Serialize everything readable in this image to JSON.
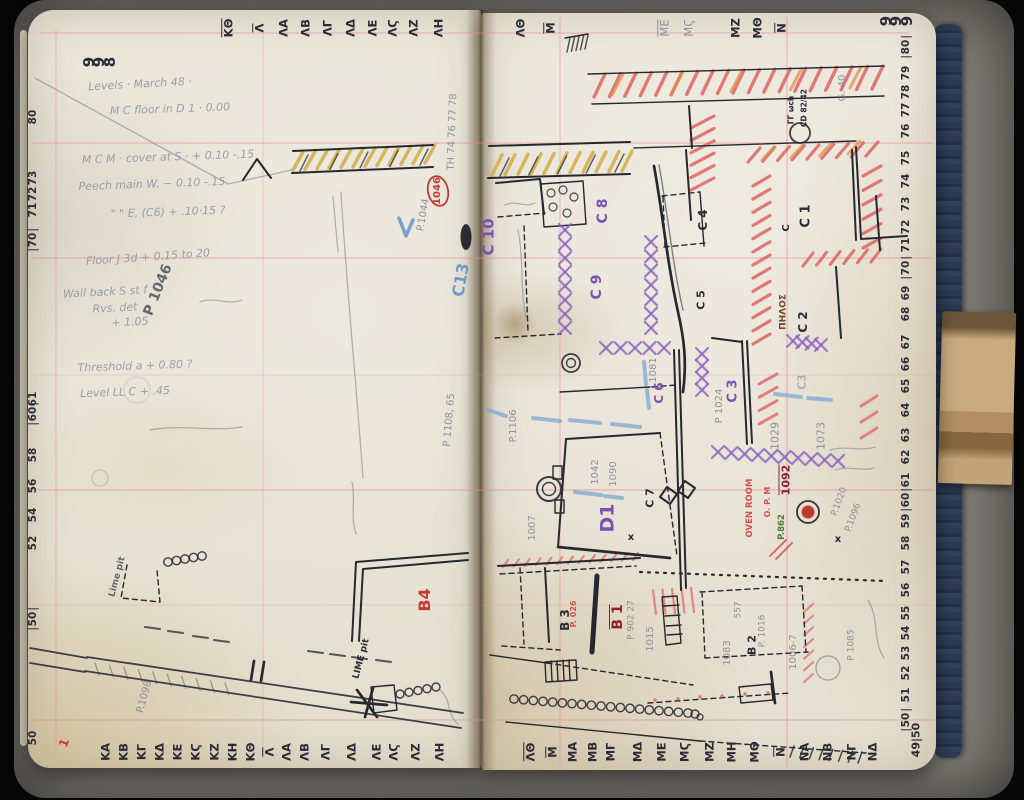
{
  "pages": {
    "left_page_number": "998",
    "right_page_number": "999",
    "corner_grid_ref": "49|50"
  },
  "scales": {
    "top": {
      "y": 28,
      "items": [
        {
          "t": "ΚΘ",
          "x": 228,
          "u": 1
        },
        {
          "t": "Λ",
          "x": 259,
          "u": 1
        },
        {
          "t": "ΛΑ",
          "x": 284
        },
        {
          "t": "ΛΒ",
          "x": 306
        },
        {
          "t": "ΛΓ",
          "x": 328
        },
        {
          "t": "ΛΔ",
          "x": 351
        },
        {
          "t": "ΛΕ",
          "x": 373
        },
        {
          "t": "ΛϚ",
          "x": 393
        },
        {
          "t": "ΛΖ",
          "x": 414
        },
        {
          "t": "ΛΗ",
          "x": 439
        },
        {
          "t": "ΛΘ",
          "x": 521
        },
        {
          "t": "Μ",
          "x": 550,
          "u": 1
        },
        {
          "t": "ΜΕ",
          "x": 664,
          "c": "pencil",
          "u": 1
        },
        {
          "t": "ΜϚ",
          "x": 689,
          "c": "pencil"
        },
        {
          "t": "ΜΖ",
          "x": 736
        },
        {
          "t": "ΜΘ",
          "x": 758
        },
        {
          "t": "Ν",
          "x": 781,
          "u": 1
        }
      ]
    },
    "bottom": {
      "y": 752,
      "items": [
        {
          "t": "ΚΑ",
          "x": 106
        },
        {
          "t": "ΚΒ",
          "x": 124
        },
        {
          "t": "ΚΓ",
          "x": 142
        },
        {
          "t": "ΚΔ",
          "x": 160
        },
        {
          "t": "ΚΕ",
          "x": 178
        },
        {
          "t": "ΚϚ",
          "x": 196
        },
        {
          "t": "ΚΖ",
          "x": 215
        },
        {
          "t": "ΚΗ",
          "x": 233
        },
        {
          "t": "ΚΘ",
          "x": 251
        },
        {
          "t": "Λ",
          "x": 269,
          "u": 1
        },
        {
          "t": "ΛΑ",
          "x": 287
        },
        {
          "t": "ΛΒ",
          "x": 305
        },
        {
          "t": "ΛΓ",
          "x": 326
        },
        {
          "t": "ΛΔ",
          "x": 352
        },
        {
          "t": "ΛΕ",
          "x": 377
        },
        {
          "t": "ΛϚ",
          "x": 394
        },
        {
          "t": "ΛΖ",
          "x": 416
        },
        {
          "t": "ΛΗ",
          "x": 440
        },
        {
          "t": "ΛΘ",
          "x": 530,
          "u": 1
        },
        {
          "t": "Μ",
          "x": 552,
          "u": 1
        },
        {
          "t": "ΜΑ",
          "x": 573
        },
        {
          "t": "ΜΒ",
          "x": 593
        },
        {
          "t": "ΜΓ",
          "x": 611
        },
        {
          "t": "ΜΔ",
          "x": 638
        },
        {
          "t": "ΜΕ",
          "x": 662
        },
        {
          "t": "ΜϚ",
          "x": 685
        },
        {
          "t": "ΜΖ",
          "x": 710
        },
        {
          "t": "ΜΗ",
          "x": 732
        },
        {
          "t": "ΜΘ",
          "x": 755
        },
        {
          "t": "Ν",
          "x": 780,
          "u": 1
        },
        {
          "t": "ΝΑ",
          "x": 805
        },
        {
          "t": "ΝΒ",
          "x": 828
        },
        {
          "t": "ΝΓ",
          "x": 852
        },
        {
          "t": "ΝΔ",
          "x": 873
        }
      ]
    },
    "left": {
      "x": 33,
      "items": [
        {
          "t": "80",
          "y": 117
        },
        {
          "t": "73",
          "y": 178
        },
        {
          "t": "72",
          "y": 194
        },
        {
          "t": "71",
          "y": 210
        },
        {
          "t": "70",
          "y": 240,
          "bx": 1
        },
        {
          "t": "61",
          "y": 399
        },
        {
          "t": "60",
          "y": 414,
          "bx": 1
        },
        {
          "t": "58",
          "y": 455
        },
        {
          "t": "56",
          "y": 486
        },
        {
          "t": "54",
          "y": 515
        },
        {
          "t": "52",
          "y": 543
        },
        {
          "t": "50",
          "y": 619,
          "bx": 1
        },
        {
          "t": "50",
          "y": 738
        }
      ]
    },
    "right": {
      "x": 906,
      "items": [
        {
          "t": "80",
          "y": 47,
          "bx": 1
        },
        {
          "t": "79",
          "y": 73
        },
        {
          "t": "78",
          "y": 92
        },
        {
          "t": "77",
          "y": 110
        },
        {
          "t": "76",
          "y": 131
        },
        {
          "t": "75",
          "y": 158
        },
        {
          "t": "74",
          "y": 181
        },
        {
          "t": "73",
          "y": 204
        },
        {
          "t": "72",
          "y": 227
        },
        {
          "t": "71",
          "y": 245
        },
        {
          "t": "70",
          "y": 268,
          "bx": 1
        },
        {
          "t": "69",
          "y": 293
        },
        {
          "t": "68",
          "y": 314
        },
        {
          "t": "67",
          "y": 342
        },
        {
          "t": "66",
          "y": 364
        },
        {
          "t": "65",
          "y": 386
        },
        {
          "t": "64",
          "y": 410
        },
        {
          "t": "63",
          "y": 435
        },
        {
          "t": "62",
          "y": 457
        },
        {
          "t": "61",
          "y": 480
        },
        {
          "t": "60",
          "y": 500,
          "bx": 1
        },
        {
          "t": "59",
          "y": 521
        },
        {
          "t": "58",
          "y": 543
        },
        {
          "t": "57",
          "y": 567
        },
        {
          "t": "56",
          "y": 590
        },
        {
          "t": "55",
          "y": 613
        },
        {
          "t": "54",
          "y": 633
        },
        {
          "t": "53",
          "y": 653
        },
        {
          "t": "52",
          "y": 673
        },
        {
          "t": "51",
          "y": 695
        },
        {
          "t": "50",
          "y": 720,
          "bx": 1
        }
      ]
    }
  },
  "notes": {
    "lines": [
      {
        "t": "Levels · March 48 ·",
        "x": 140,
        "y": 84,
        "r": -3
      },
      {
        "t": "M C floor in D 1 · 0.00",
        "x": 170,
        "y": 109,
        "r": -2
      },
      {
        "t": "M C M · cover at S · + 0.10 -.15",
        "x": 168,
        "y": 157,
        "r": -2
      },
      {
        "t": "Peech main W.  − 0.10 -.15",
        "x": 152,
        "y": 184,
        "r": -2
      },
      {
        "t": "\"  \"  E, (C6) + .10·15  ?",
        "x": 168,
        "y": 212,
        "r": -2
      },
      {
        "t": "Floor J 3d  + 0.15 to 20",
        "x": 148,
        "y": 257,
        "r": -4
      },
      {
        "t": "Wall back S st f",
        "x": 105,
        "y": 292,
        "r": -3
      },
      {
        "t": "Rvs. det",
        "x": 115,
        "y": 308,
        "r": -3
      },
      {
        "t": "+ 1.05",
        "x": 130,
        "y": 322,
        "r": -3
      },
      {
        "t": "Threshold a  + 0.80 ?",
        "x": 135,
        "y": 366,
        "r": -2
      },
      {
        "t": "Level LL C  + .45",
        "x": 125,
        "y": 392,
        "r": -2
      }
    ]
  },
  "labels": [
    {
      "t": "998",
      "x": 100,
      "y": 62,
      "cr": 1,
      "c": "ink",
      "s": 15,
      "n": "page-number-left"
    },
    {
      "t": "999",
      "x": 897,
      "y": 21,
      "cr": 1,
      "c": "ink",
      "s": 15,
      "n": "page-number-right"
    },
    {
      "t": "49|50",
      "x": 916,
      "y": 740,
      "c": "ink",
      "s": 11,
      "n": "corner-grid-ref"
    },
    {
      "t": "P 1046",
      "x": 158,
      "y": 290,
      "r": -68,
      "c": "pencil-dk",
      "s": 14
    },
    {
      "t": "1046",
      "x": 438,
      "y": 191,
      "c": "red",
      "s": 10
    },
    {
      "t": "P.1044",
      "x": 424,
      "y": 215,
      "r": -80,
      "c": "pencil",
      "s": 10
    },
    {
      "t": "TH 74 76 77 78",
      "x": 453,
      "y": 132,
      "r": -88,
      "c": "pencil",
      "s": 10
    },
    {
      "t": "C13",
      "x": 461,
      "y": 280,
      "r": -80,
      "c": "blue",
      "s": 16
    },
    {
      "t": "P 1108, 65",
      "x": 450,
      "y": 420,
      "r": -85,
      "c": "pencil",
      "s": 10
    },
    {
      "t": "Lime pit",
      "x": 118,
      "y": 577,
      "r": -75,
      "c": "pencil-dk",
      "s": 9
    },
    {
      "t": "LIME pit",
      "x": 362,
      "y": 659,
      "r": -75,
      "c": "ink",
      "s": 9
    },
    {
      "t": "B4",
      "x": 425,
      "y": 600,
      "c": "red",
      "s": 16
    },
    {
      "t": "P.1098",
      "x": 145,
      "y": 697,
      "r": -75,
      "c": "pencil",
      "s": 10
    },
    {
      "t": "1",
      "x": 64,
      "y": 743,
      "r": -70,
      "c": "red",
      "s": 12
    },
    {
      "t": "C 10",
      "x": 489,
      "y": 237,
      "c": "purple",
      "s": 15
    },
    {
      "t": "C 8",
      "x": 603,
      "y": 211,
      "c": "purple",
      "s": 14
    },
    {
      "t": "C 9",
      "x": 597,
      "y": 287,
      "c": "purple",
      "s": 14
    },
    {
      "t": "C 6",
      "x": 659,
      "y": 393,
      "c": "purple",
      "s": 12
    },
    {
      "t": "C 3",
      "x": 733,
      "y": 391,
      "c": "purple",
      "s": 13
    },
    {
      "t": "D1",
      "x": 608,
      "y": 518,
      "c": "purple",
      "s": 19
    },
    {
      "t": "C 4",
      "x": 703,
      "y": 220,
      "c": "ink",
      "s": 12
    },
    {
      "t": "C 5",
      "x": 701,
      "y": 300,
      "c": "ink",
      "s": 11
    },
    {
      "t": "C 1",
      "x": 806,
      "y": 216,
      "c": "ink",
      "s": 13
    },
    {
      "t": "C 2",
      "x": 803,
      "y": 322,
      "c": "ink",
      "s": 12
    },
    {
      "t": "C 7",
      "x": 650,
      "y": 498,
      "c": "ink",
      "s": 11
    },
    {
      "t": "C",
      "x": 787,
      "y": 228,
      "c": "ink",
      "s": 10
    },
    {
      "t": "B 3",
      "x": 565,
      "y": 620,
      "c": "ink",
      "s": 12
    },
    {
      "t": "B 2",
      "x": 752,
      "y": 645,
      "c": "ink",
      "s": 11
    },
    {
      "t": "B 1",
      "x": 617,
      "y": 617,
      "c": "maroon",
      "s": 14,
      "u": 1
    },
    {
      "t": "1092",
      "x": 785,
      "y": 480,
      "c": "maroon",
      "s": 11,
      "u": 1
    },
    {
      "t": "OVEN ROOM",
      "x": 750,
      "y": 508,
      "c": "redlt",
      "s": 8.5
    },
    {
      "t": "O. P. M",
      "x": 768,
      "y": 502,
      "c": "redlt",
      "s": 8
    },
    {
      "t": "P. 026",
      "x": 574,
      "y": 614,
      "c": "redlt",
      "s": 8
    },
    {
      "t": "P.862",
      "x": 782,
      "y": 527,
      "c": "green",
      "s": 8.5
    },
    {
      "t": "ΠΗΛΟΣ",
      "x": 784,
      "y": 312,
      "c": "brown",
      "s": 9
    },
    {
      "t": "1081",
      "x": 654,
      "y": 370,
      "c": "pencil",
      "s": 10
    },
    {
      "t": "P 1024",
      "x": 720,
      "y": 406,
      "c": "pencil",
      "s": 10
    },
    {
      "t": "C3",
      "x": 802,
      "y": 382,
      "c": "pencil",
      "s": 11
    },
    {
      "t": "1029",
      "x": 775,
      "y": 436,
      "c": "pencil",
      "s": 11
    },
    {
      "t": "1073",
      "x": 821,
      "y": 436,
      "c": "pencil",
      "s": 11
    },
    {
      "t": "1042",
      "x": 596,
      "y": 472,
      "c": "pencil",
      "s": 10
    },
    {
      "t": "1090",
      "x": 614,
      "y": 474,
      "c": "pencil",
      "s": 10
    },
    {
      "t": "P.1106",
      "x": 514,
      "y": 426,
      "c": "pencil",
      "s": 10
    },
    {
      "t": "1007",
      "x": 533,
      "y": 528,
      "c": "pencil",
      "s": 10
    },
    {
      "t": "P 902 27",
      "x": 632,
      "y": 620,
      "c": "pencil",
      "s": 9
    },
    {
      "t": "1015",
      "x": 651,
      "y": 639,
      "c": "pencil",
      "s": 10
    },
    {
      "t": "1083",
      "x": 728,
      "y": 653,
      "c": "pencil",
      "s": 10
    },
    {
      "t": "557",
      "x": 739,
      "y": 610,
      "c": "pencil",
      "s": 9
    },
    {
      "t": "P. 1016",
      "x": 763,
      "y": 631,
      "c": "pencil",
      "s": 9
    },
    {
      "t": "1006-7",
      "x": 794,
      "y": 652,
      "c": "pencil",
      "s": 10
    },
    {
      "t": "P 1085",
      "x": 852,
      "y": 645,
      "c": "pencil",
      "s": 9
    },
    {
      "t": "P.1020",
      "x": 840,
      "y": 502,
      "r": -70,
      "c": "pencil",
      "s": 9
    },
    {
      "t": "P.1096",
      "x": 854,
      "y": 518,
      "r": -70,
      "c": "pencil",
      "s": 9
    },
    {
      "t": "G. 40",
      "x": 843,
      "y": 88,
      "c": "pencil",
      "s": 10
    },
    {
      "t": "ΓΓ ωch",
      "x": 791,
      "y": 110,
      "c": "ink",
      "s": 7.5
    },
    {
      "t": "CD 82/42",
      "x": 804,
      "y": 108,
      "c": "ink",
      "s": 7.5
    },
    {
      "t": "x",
      "x": 631,
      "y": 538,
      "r": 0,
      "c": "ink",
      "s": 10
    },
    {
      "t": "x",
      "x": 838,
      "y": 540,
      "r": 0,
      "c": "ink",
      "s": 10
    }
  ]
}
